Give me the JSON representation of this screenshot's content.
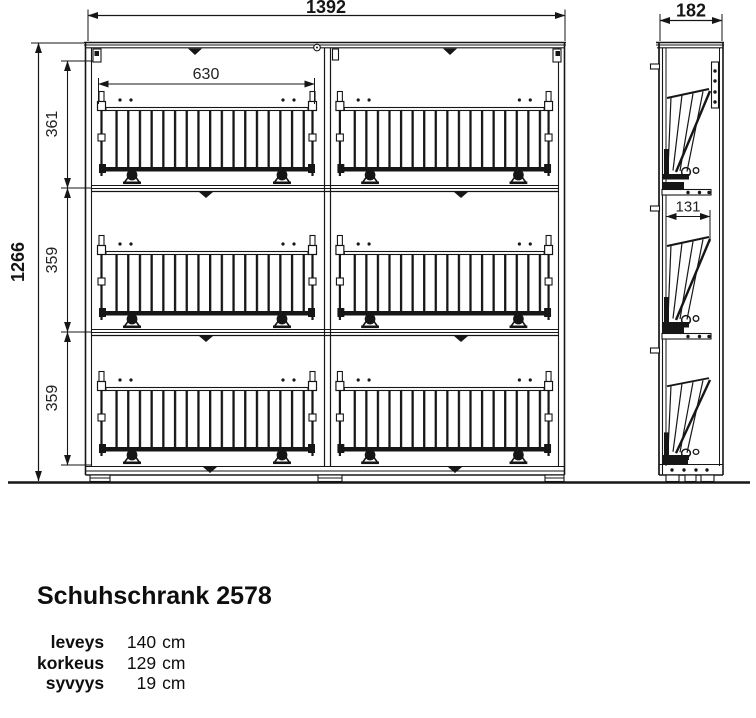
{
  "drawing": {
    "front_view": {
      "width_label": "1392",
      "height_label": "1266",
      "compartment_labels": [
        "361",
        "359",
        "359"
      ],
      "basket_width_label": "630"
    },
    "side_view": {
      "depth_label": "182",
      "basket_depth_label": "131"
    }
  },
  "product": {
    "title": "Schuhschrank 2578",
    "specs": [
      {
        "label": "leveys",
        "value": "140",
        "unit": "cm"
      },
      {
        "label": "korkeus",
        "value": "129",
        "unit": "cm"
      },
      {
        "label": "syvyys",
        "value": "19",
        "unit": "cm"
      }
    ]
  },
  "colors": {
    "line": "#161616",
    "background": "#ffffff"
  }
}
